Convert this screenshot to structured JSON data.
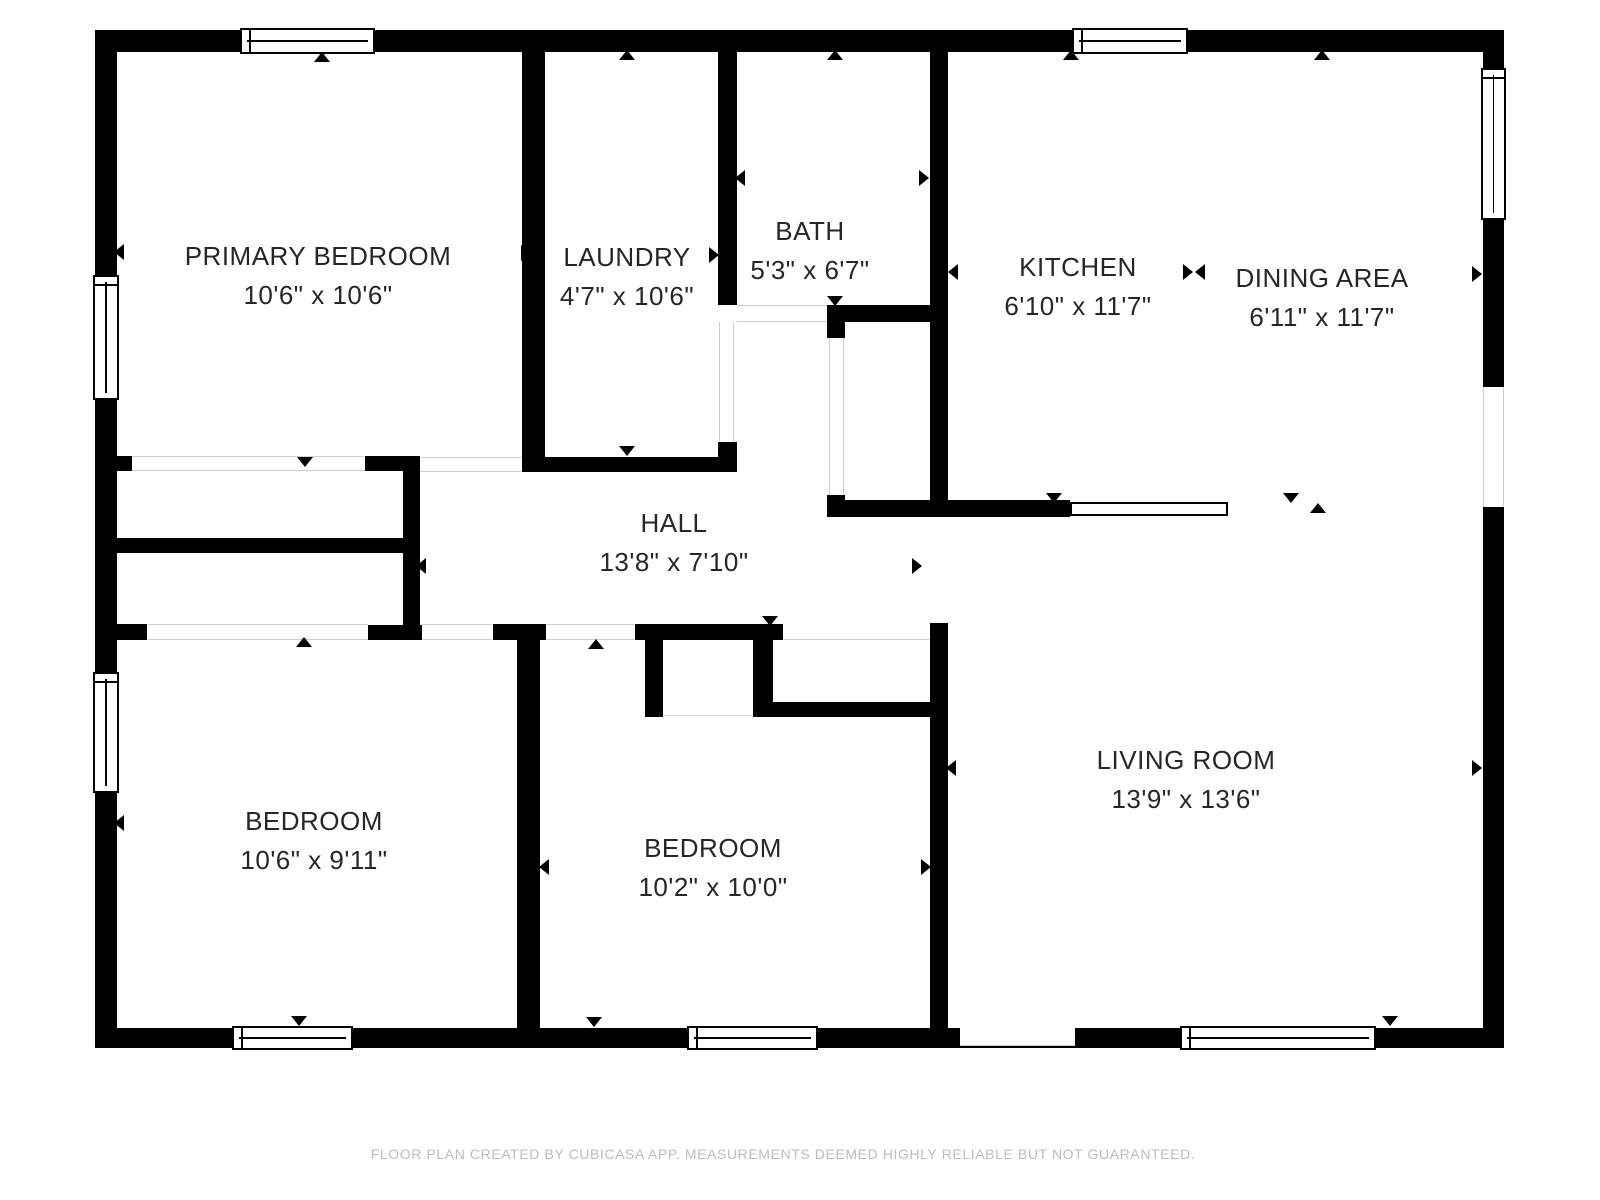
{
  "footer": {
    "text": "FLOOR PLAN CREATED BY CUBICASA APP. MEASUREMENTS DEEMED HIGHLY RELIABLE BUT NOT GUARANTEED.",
    "x": 783,
    "y": 1146
  },
  "colors": {
    "wall": "#000000",
    "label": "#262626",
    "thin_line": "#cfcfcf",
    "footer": "#bcbcbc",
    "background": "#ffffff"
  },
  "rooms": [
    {
      "id": "primary-bedroom",
      "name": "PRIMARY BEDROOM",
      "dims": "10'6\" x 10'6\"",
      "cx": 318,
      "cy": 276
    },
    {
      "id": "laundry",
      "name": "LAUNDRY",
      "dims": "4'7\" x 10'6\"",
      "cx": 627,
      "cy": 277
    },
    {
      "id": "bath",
      "name": "BATH",
      "dims": "5'3\" x 6'7\"",
      "cx": 810,
      "cy": 251
    },
    {
      "id": "kitchen",
      "name": "KITCHEN",
      "dims": "6'10\" x 11'7\"",
      "cx": 1078,
      "cy": 287
    },
    {
      "id": "dining-area",
      "name": "DINING AREA",
      "dims": "6'11\" x 11'7\"",
      "cx": 1322,
      "cy": 298
    },
    {
      "id": "hall",
      "name": "HALL",
      "dims": "13'8\" x 7'10\"",
      "cx": 674,
      "cy": 543
    },
    {
      "id": "bedroom-left",
      "name": "BEDROOM",
      "dims": "10'6\" x 9'11\"",
      "cx": 314,
      "cy": 841
    },
    {
      "id": "bedroom-middle",
      "name": "BEDROOM",
      "dims": "10'2\" x 10'0\"",
      "cx": 713,
      "cy": 868
    },
    {
      "id": "living-room",
      "name": "LIVING ROOM",
      "dims": "13'9\" x 13'6\"",
      "cx": 1186,
      "cy": 780
    }
  ],
  "plan": {
    "walls": [
      {
        "x": 95,
        "y": 30,
        "w": 1409,
        "h": 22
      },
      {
        "x": 95,
        "y": 1028,
        "w": 1409,
        "h": 20
      },
      {
        "x": 95,
        "y": 30,
        "w": 22,
        "h": 1018
      },
      {
        "x": 1483,
        "y": 30,
        "w": 21,
        "h": 1018
      },
      {
        "x": 522,
        "y": 52,
        "w": 23,
        "h": 420
      },
      {
        "x": 718,
        "y": 52,
        "w": 19,
        "h": 253
      },
      {
        "x": 718,
        "y": 442,
        "w": 19,
        "h": 30
      },
      {
        "x": 545,
        "y": 457,
        "w": 192,
        "h": 15
      },
      {
        "x": 117,
        "y": 456,
        "w": 15,
        "h": 15
      },
      {
        "x": 365,
        "y": 456,
        "w": 55,
        "h": 15
      },
      {
        "x": 403,
        "y": 456,
        "w": 17,
        "h": 184
      },
      {
        "x": 117,
        "y": 538,
        "w": 286,
        "h": 15
      },
      {
        "x": 368,
        "y": 625,
        "w": 54,
        "h": 15
      },
      {
        "x": 117,
        "y": 624,
        "w": 30,
        "h": 16
      },
      {
        "x": 493,
        "y": 624,
        "w": 53,
        "h": 16
      },
      {
        "x": 635,
        "y": 624,
        "w": 148,
        "h": 16
      },
      {
        "x": 517,
        "y": 624,
        "w": 23,
        "h": 404
      },
      {
        "x": 930,
        "y": 623,
        "w": 18,
        "h": 425
      },
      {
        "x": 645,
        "y": 638,
        "w": 18,
        "h": 79
      },
      {
        "x": 753,
        "y": 638,
        "w": 20,
        "h": 64
      },
      {
        "x": 753,
        "y": 702,
        "w": 195,
        "h": 15
      },
      {
        "x": 827,
        "y": 305,
        "w": 121,
        "h": 17
      },
      {
        "x": 930,
        "y": 52,
        "w": 18,
        "h": 465
      },
      {
        "x": 827,
        "y": 322,
        "w": 18,
        "h": 16
      },
      {
        "x": 827,
        "y": 495,
        "w": 18,
        "h": 22
      },
      {
        "x": 827,
        "y": 500,
        "w": 243,
        "h": 17
      }
    ],
    "openings": [
      {
        "x": 132,
        "y": 456,
        "w": 233,
        "h": 15,
        "edges": "tb"
      },
      {
        "x": 420,
        "y": 457,
        "w": 102,
        "h": 15,
        "edges": "tb"
      },
      {
        "x": 147,
        "y": 624,
        "w": 221,
        "h": 16,
        "edges": "tb"
      },
      {
        "x": 422,
        "y": 624,
        "w": 71,
        "h": 16,
        "edges": "tb"
      },
      {
        "x": 546,
        "y": 624,
        "w": 89,
        "h": 16,
        "edges": "tb"
      },
      {
        "x": 783,
        "y": 624,
        "w": 147,
        "h": 16,
        "edges": "b"
      },
      {
        "x": 663,
        "y": 703,
        "w": 90,
        "h": 13,
        "edges": "b"
      },
      {
        "x": 737,
        "y": 305,
        "w": 90,
        "h": 17,
        "edges": "tb"
      },
      {
        "x": 719,
        "y": 322,
        "w": 15,
        "h": 120,
        "edges": "lr"
      },
      {
        "x": 829,
        "y": 338,
        "w": 15,
        "h": 157,
        "edges": "lr"
      },
      {
        "x": 1483,
        "y": 387,
        "w": 21,
        "h": 120,
        "edges": "lr"
      },
      {
        "x": 960,
        "y": 1028,
        "w": 115,
        "h": 18,
        "edges": "b"
      }
    ],
    "windows": [
      {
        "x": 240,
        "y": 28,
        "w": 135,
        "h": 26,
        "o": "h"
      },
      {
        "x": 1072,
        "y": 28,
        "w": 116,
        "h": 26,
        "o": "h"
      },
      {
        "x": 232,
        "y": 1026,
        "w": 121,
        "h": 24,
        "o": "h"
      },
      {
        "x": 687,
        "y": 1026,
        "w": 131,
        "h": 24,
        "o": "h"
      },
      {
        "x": 1180,
        "y": 1026,
        "w": 196,
        "h": 24,
        "o": "h"
      },
      {
        "x": 93,
        "y": 275,
        "w": 26,
        "h": 125,
        "o": "v"
      },
      {
        "x": 93,
        "y": 672,
        "w": 26,
        "h": 121,
        "o": "v"
      },
      {
        "x": 1481,
        "y": 68,
        "w": 25,
        "h": 152,
        "o": "v"
      }
    ],
    "counter": {
      "x": 1070,
      "y": 502,
      "w": 158,
      "h": 14
    },
    "arrows": [
      {
        "x": 322,
        "y": 57,
        "d": "up"
      },
      {
        "x": 305,
        "y": 462,
        "d": "down"
      },
      {
        "x": 119,
        "y": 252,
        "d": "left"
      },
      {
        "x": 526,
        "y": 253,
        "d": "right"
      },
      {
        "x": 540,
        "y": 253,
        "d": "left"
      },
      {
        "x": 627,
        "y": 55,
        "d": "up"
      },
      {
        "x": 627,
        "y": 451,
        "d": "down"
      },
      {
        "x": 714,
        "y": 255,
        "d": "right"
      },
      {
        "x": 835,
        "y": 55,
        "d": "up"
      },
      {
        "x": 835,
        "y": 301,
        "d": "down"
      },
      {
        "x": 740,
        "y": 178,
        "d": "left"
      },
      {
        "x": 924,
        "y": 178,
        "d": "right"
      },
      {
        "x": 1071,
        "y": 55,
        "d": "up"
      },
      {
        "x": 1054,
        "y": 498,
        "d": "down"
      },
      {
        "x": 953,
        "y": 272,
        "d": "left"
      },
      {
        "x": 1188,
        "y": 272,
        "d": "right"
      },
      {
        "x": 1200,
        "y": 272,
        "d": "left"
      },
      {
        "x": 1322,
        "y": 55,
        "d": "up"
      },
      {
        "x": 1291,
        "y": 498,
        "d": "down"
      },
      {
        "x": 1318,
        "y": 508,
        "d": "up"
      },
      {
        "x": 1477,
        "y": 274,
        "d": "right"
      },
      {
        "x": 1477,
        "y": 768,
        "d": "right"
      },
      {
        "x": 951,
        "y": 768,
        "d": "left"
      },
      {
        "x": 1390,
        "y": 1021,
        "d": "down"
      },
      {
        "x": 421,
        "y": 566,
        "d": "left"
      },
      {
        "x": 917,
        "y": 566,
        "d": "right"
      },
      {
        "x": 770,
        "y": 621,
        "d": "down"
      },
      {
        "x": 596,
        "y": 644,
        "d": "up"
      },
      {
        "x": 304,
        "y": 642,
        "d": "up"
      },
      {
        "x": 119,
        "y": 823,
        "d": "left"
      },
      {
        "x": 524,
        "y": 831,
        "d": "right"
      },
      {
        "x": 544,
        "y": 867,
        "d": "left"
      },
      {
        "x": 926,
        "y": 867,
        "d": "right"
      },
      {
        "x": 299,
        "y": 1021,
        "d": "down"
      },
      {
        "x": 594,
        "y": 1022,
        "d": "down"
      }
    ]
  }
}
